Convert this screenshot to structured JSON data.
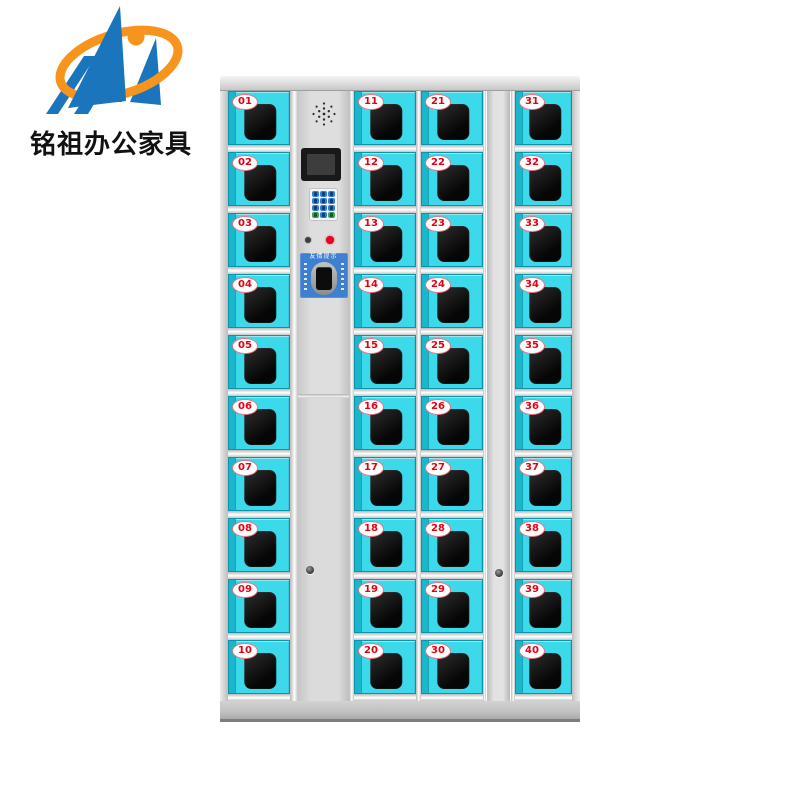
{
  "brand": {
    "logo_text": "铭祖办公家具"
  },
  "colors": {
    "doorCyan": "#3cd9ea",
    "doorCyanDark": "#1ab7cc",
    "numberRed": "#e60012",
    "indicatorRed": "#e8001e",
    "panelBlue": "#3f7fd0",
    "keypadBlue": "#2f7fd8",
    "keypadGreen": "#3fa54b",
    "logoBlue": "#1b75bc",
    "logoOrange": "#f7941d"
  },
  "cabinet": {
    "columns": [
      {
        "name": "column-1",
        "doors": [
          "01",
          "02",
          "03",
          "04",
          "05",
          "06",
          "07",
          "08",
          "09",
          "10"
        ]
      },
      {
        "name": "column-2",
        "doors": [
          "11",
          "12",
          "13",
          "14",
          "15",
          "16",
          "17",
          "18",
          "19",
          "20"
        ]
      },
      {
        "name": "column-3",
        "doors": [
          "21",
          "22",
          "23",
          "24",
          "25",
          "26",
          "27",
          "28",
          "29",
          "30"
        ]
      },
      {
        "name": "column-4",
        "doors": [
          "31",
          "32",
          "33",
          "34",
          "35",
          "36",
          "37",
          "38",
          "39",
          "40"
        ]
      }
    ],
    "control_panel": {
      "reader_title": "友情提示",
      "keypad": {
        "buttons": [
          "blue",
          "blue",
          "blue",
          "blue",
          "blue",
          "blue",
          "blue",
          "blue",
          "blue",
          "green",
          "blue",
          "green"
        ]
      }
    }
  }
}
